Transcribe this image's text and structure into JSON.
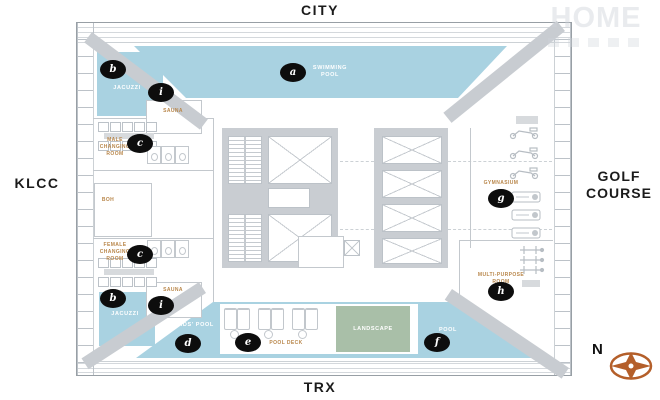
{
  "orientation": {
    "top": "CITY",
    "bottom": "TRX",
    "left": "KLCC",
    "right": "GOLF COURSE",
    "compass_north": "N"
  },
  "watermark": {
    "text": "HOME"
  },
  "areas": {
    "swimming_pool": {
      "letter": "a",
      "label": "SWIMMING POOL"
    },
    "jacuzzi": {
      "letter": "b",
      "label": "JACUZZI"
    },
    "male_changing_room": {
      "letter": "c",
      "label": "MALE CHANGING ROOM"
    },
    "female_changing_room": {
      "letter": "c",
      "label": "FEMALE CHANGING ROOM"
    },
    "kids_pool": {
      "letter": "d",
      "label": "KIDS' POOL"
    },
    "pool_deck": {
      "letter": "e",
      "label": "POOL DECK"
    },
    "pool": {
      "letter": "f",
      "label": "POOL"
    },
    "gymnasium": {
      "letter": "g",
      "label": "GYMNASIUM"
    },
    "multi_purpose_room": {
      "letter": "h",
      "label": "MULTI-PURPOSE ROOM"
    },
    "sauna": {
      "letter": "i",
      "label": "SAUNA"
    }
  },
  "rooms": {
    "boh": "BOH",
    "landscape": "LANDSCAPE"
  },
  "colors": {
    "water": "#a9d2e1",
    "landscape_green": "#a9bfa8",
    "structure_gray": "#c8ccd1",
    "label_tan": "#b9874b",
    "marker_black": "#0d0d0d",
    "compass_orange": "#b45f2a"
  }
}
